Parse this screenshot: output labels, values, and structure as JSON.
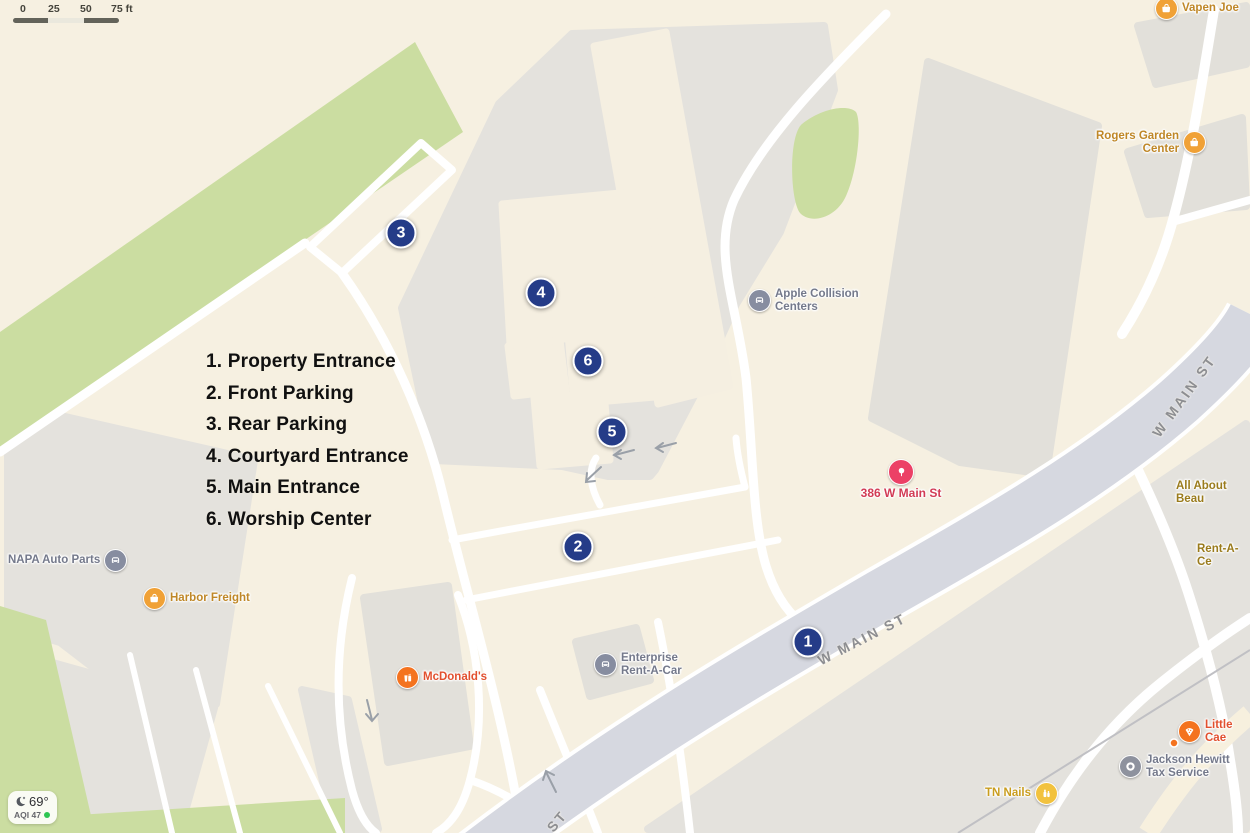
{
  "map": {
    "scale_bar": {
      "labels": [
        "0",
        "25",
        "50",
        "75 ft"
      ]
    },
    "legend": {
      "items": [
        "1. Property Entrance",
        "2. Front Parking",
        "3. Rear Parking",
        "4. Courtyard Entrance",
        "5. Main Entrance",
        "6. Worship Center"
      ]
    },
    "markers": [
      "1",
      "2",
      "3",
      "4",
      "5",
      "6"
    ],
    "streets": [
      "W MAIN ST",
      "W MAIN ST",
      "ST"
    ],
    "pois": {
      "vapen_joe": {
        "label": "Vapen Joe"
      },
      "rogers_garden_center": {
        "label": "Rogers Garden\nCenter"
      },
      "apple_collision": {
        "label": "Apple Collision\nCenters"
      },
      "address_386": {
        "label": "386 W Main St"
      },
      "all_about_beau": {
        "label": "All About Beau"
      },
      "rent_a_ce": {
        "label": "Rent-A-Ce"
      },
      "napa_auto_parts": {
        "label": "NAPA Auto Parts"
      },
      "harbor_freight": {
        "label": "Harbor Freight"
      },
      "mcdonalds": {
        "label": "McDonald's"
      },
      "enterprise": {
        "label": "Enterprise\nRent-A-Car"
      },
      "little_caesars": {
        "label": "Little Cae"
      },
      "tn_nails": {
        "label": "TN Nails"
      },
      "jackson_hewitt": {
        "label": "Jackson Hewitt\nTax Service"
      }
    },
    "weather": {
      "temp": "69°",
      "aqi": "AQI 47"
    },
    "colors": {
      "marker_blue": "#253c88",
      "map_cream": "#f6f0e1",
      "greenery": "#cbdda1",
      "lot_gray": "#e4e2dd",
      "building_gray": "#e2e0da",
      "main_road": "#d6d8e0",
      "poi_orange": "#f0a136",
      "poi_redorange": "#f4731f",
      "poi_slate": "#878da0",
      "poi_gold": "#f2c23e",
      "poi_pin_red": "#ec4066",
      "street_label": "#8d8e92",
      "aqi_green": "#2fc553"
    }
  }
}
